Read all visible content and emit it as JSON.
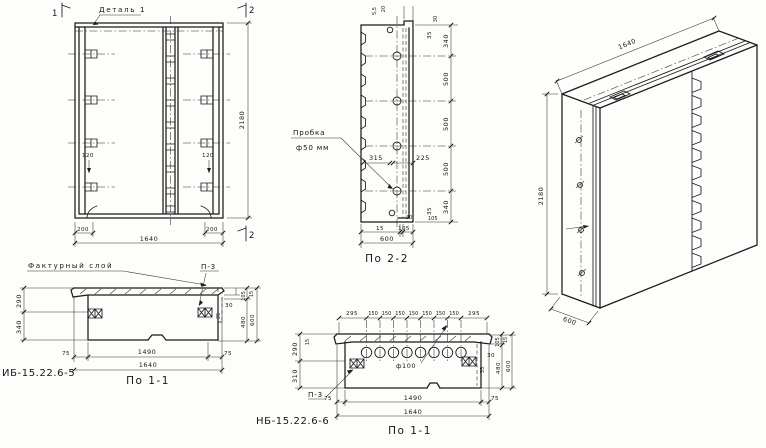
{
  "front_view": {
    "detail_label": "Деталь 1",
    "marker_top_left": "1",
    "marker_top_right": "2",
    "marker_bottom_right": "2",
    "dim_height": "2180",
    "dim_total_width": "1640",
    "dim_edge_left": "200",
    "dim_edge_right": "200",
    "dim_insert_left": "120",
    "dim_insert_right": "120"
  },
  "section_2_2": {
    "title": "По 2-2",
    "plug_label_top": "Пробка",
    "plug_label_bottom": "ф50 мм",
    "dim_top_small_a": "5,5",
    "dim_top_small_b": "20",
    "dim_top_small_c": "30",
    "dim_right": [
      "35",
      "340",
      "500",
      "500",
      "500",
      "340",
      "35"
    ],
    "dim_mid_left": "315",
    "dim_mid_right": "225",
    "dim_bottom_small_a": "30",
    "dim_bottom_small_b": "105",
    "dim_bottom_a": "15",
    "dim_bottom_b": "105",
    "dim_bottom_total": "600"
  },
  "iso_view": {
    "dim_width": "1640",
    "dim_height": "2180",
    "dim_depth": "600"
  },
  "section_1_1_left": {
    "designation": "ИБ-15.22.6-5",
    "title": "По 1-1",
    "facing_layer_label": "Фактурный слой",
    "plate_label": "П-3",
    "dim_left_top": "290",
    "dim_left_bottom": "340",
    "dim_facing": "30",
    "dim_gap": "35",
    "dim_right": [
      "105",
      "15",
      "480",
      "600"
    ],
    "dim_bottom_left": "75",
    "dim_bottom_mid": "1490",
    "dim_bottom_right": "75",
    "dim_bottom_total": "1640"
  },
  "section_1_1_mid": {
    "designation": "НБ-15.22.6-6",
    "title": "По 1-1",
    "hole_label": "ф100",
    "plate_label": "П-3",
    "dim_top_edge_left": "295",
    "dim_top_spacing": "150",
    "dim_top_edge_right": "295",
    "dim_left_small": "15",
    "dim_left_top": "290",
    "dim_left_bottom": "310",
    "dim_facing": "30",
    "dim_gap": "35",
    "dim_right": [
      "105",
      "15",
      "480",
      "600"
    ],
    "dim_bottom_left": "75",
    "dim_bottom_mid": "1490",
    "dim_bottom_right": "75",
    "dim_bottom_total": "1640"
  }
}
